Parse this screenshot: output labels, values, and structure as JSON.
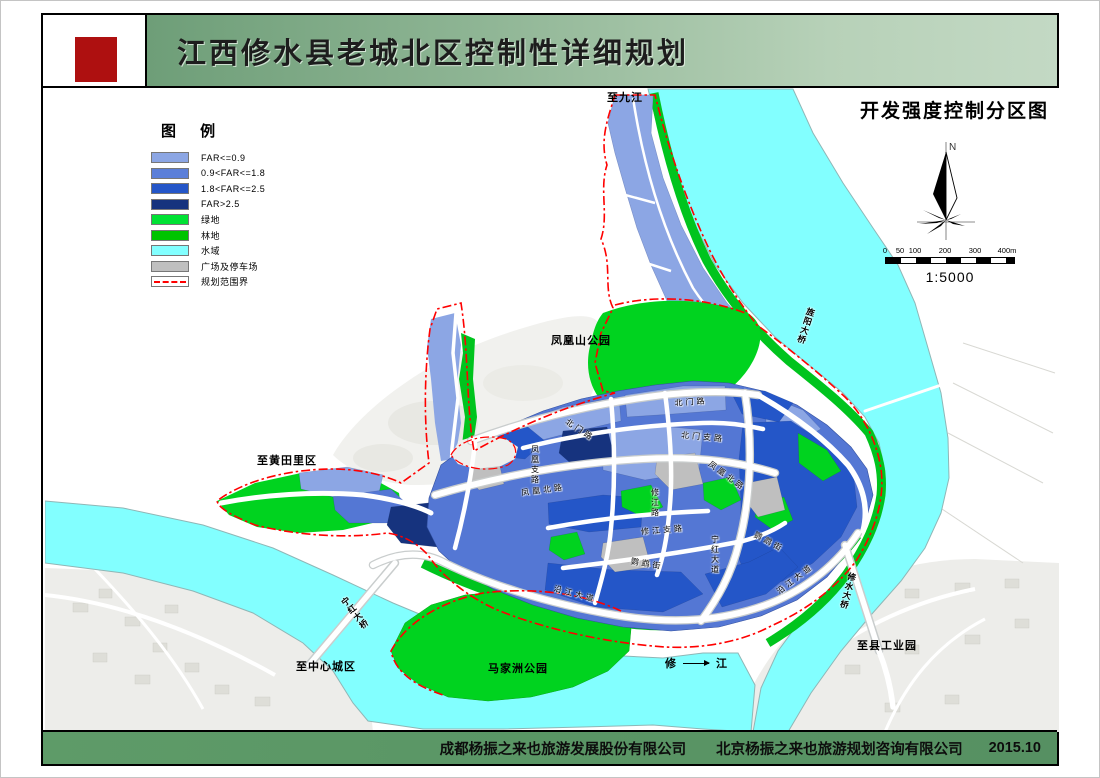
{
  "header": {
    "title": "江西修水县老城北区控制性详细规划"
  },
  "map": {
    "title": "开发强度控制分区图",
    "north": "N",
    "scale": {
      "ticks": [
        "0",
        "50",
        "100",
        "200",
        "300",
        "400m"
      ],
      "ratio": "1:5000"
    },
    "labels": {
      "to_jiujiang": "至九江",
      "fenghuangshan_park": "凤凰山公园",
      "to_huangtianli": "至黄田里区",
      "to_city_center": "至中心城区",
      "majiazhou_park": "马家洲公园",
      "to_county_industrial_park": "至县工业园",
      "xiu_river_left": "修",
      "xiu_river_right": "江"
    },
    "bridges": {
      "ninghong": "宁红大桥",
      "xiushui": "修水大桥",
      "jingyang": "旌阳大桥"
    },
    "roads": {
      "beimen_lu": "北门路",
      "beimen_zhilu": "北门支路",
      "fenghuang_beilu": "凤凰北路",
      "fenghuang_zhilu": "凤凰支路",
      "xiujiang_zhilu": "修江支路",
      "xiujiang_lu": "修江路",
      "yingwu_jie": "鹦鹉街",
      "yanjiang_dadao": "沿江大道",
      "ninghong_dadao": "宁红大道"
    }
  },
  "legend": {
    "title": "图  例",
    "items": [
      {
        "label": "FAR<=0.9",
        "color": "#8CA6E4"
      },
      {
        "label": "0.9<FAR<=1.8",
        "color": "#5B7FD9"
      },
      {
        "label": "1.8<FAR<=2.5",
        "color": "#2456C8"
      },
      {
        "label": "FAR>2.5",
        "color": "#16337E"
      },
      {
        "label": "绿地",
        "color": "#00E234"
      },
      {
        "label": "林地",
        "color": "#00C400"
      },
      {
        "label": "水域",
        "color": "#82FFFF"
      },
      {
        "label": "广场及停车场",
        "color": "#BFBFBF"
      },
      {
        "label": "规划范围界",
        "color": "#FF0000",
        "style": "dash-dot-line"
      }
    ]
  },
  "footer": {
    "company1": "成都杨振之来也旅游发展股份有限公司",
    "company2": "北京杨振之来也旅游规划咨询有限公司",
    "date": "2015.10"
  }
}
